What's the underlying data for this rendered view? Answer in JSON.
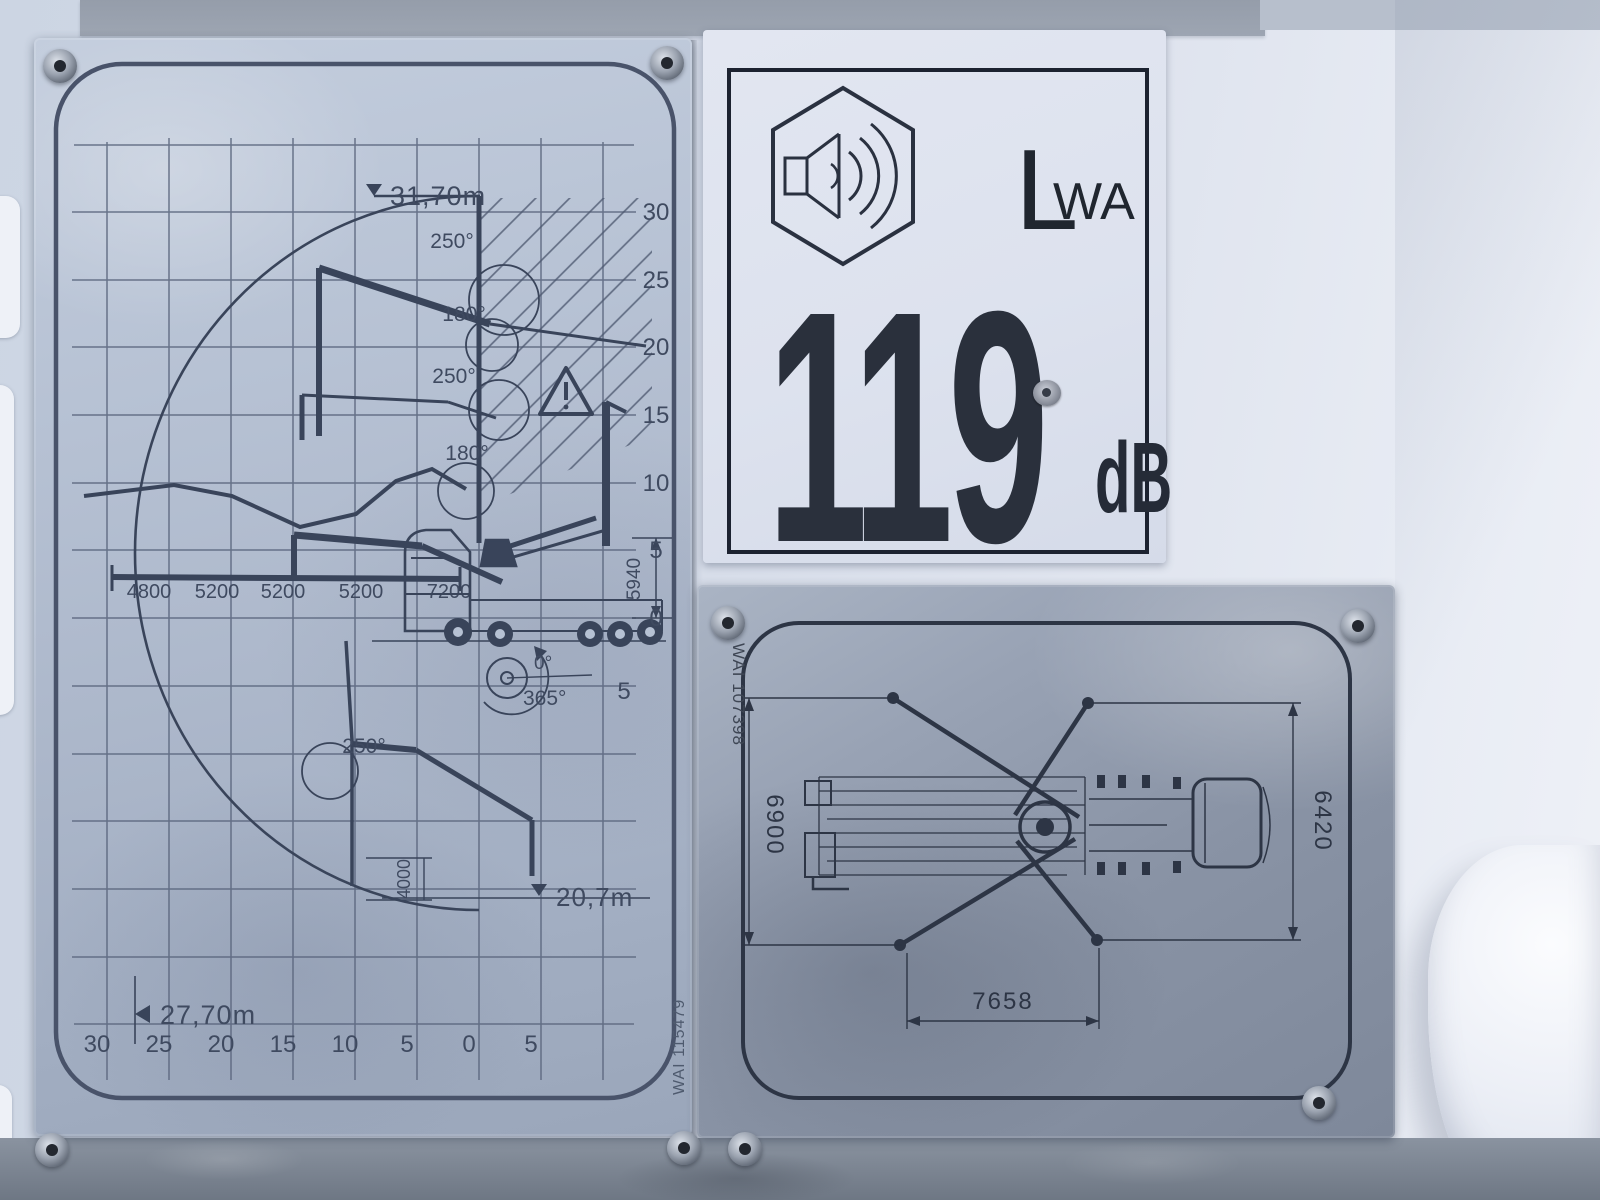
{
  "range_placard": {
    "serial": "WAI 115479",
    "max_height": "31,70m",
    "max_reach": "27,70m",
    "max_depth": "20,7m",
    "mast_height_mm": "5940",
    "fold_dim_mm": "4000",
    "rotation_from": "0°",
    "rotation_to": "365°",
    "angles": [
      "250°",
      "180°",
      "250°",
      "180°",
      "250°"
    ],
    "segments": [
      "4800",
      "5200",
      "5200",
      "5200",
      "7200"
    ],
    "y_ticks": [
      "30",
      "25",
      "20",
      "15",
      "10",
      "5",
      "0"
    ],
    "y_below_tick": "5",
    "x_ticks": [
      "30",
      "25",
      "20",
      "15",
      "10",
      "5",
      "0",
      "5"
    ]
  },
  "noise_sticker": {
    "symbol": "sound-power-speaker-hexagon",
    "label_main": "L",
    "label_sub": "WA",
    "value": "119",
    "unit": "dB"
  },
  "outrigger_placard": {
    "serial": "WAI 107398",
    "dim_left_mm": "6900",
    "dim_right_mm": "6420",
    "dim_bottom_mm": "7658"
  }
}
